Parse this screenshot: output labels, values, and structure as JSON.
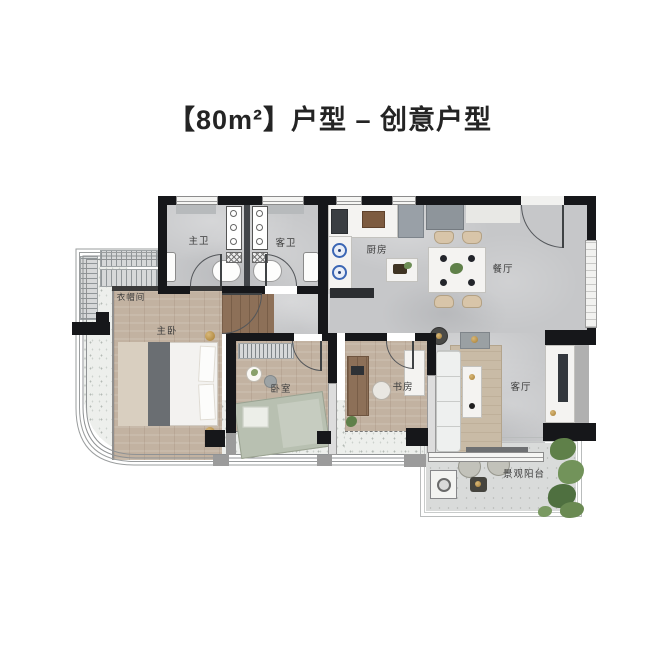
{
  "title": "【80m²】户型 – 创意户型",
  "rooms": {
    "master_bath": "主卫",
    "guest_bath": "客卫",
    "kitchen": "厨房",
    "dining": "餐厅",
    "cloakroom": "衣帽间",
    "master_bedroom": "主卧",
    "bedroom": "卧室",
    "study": "书房",
    "living": "客厅",
    "balcony": "景观阳台"
  },
  "colors": {
    "wall": "#16171a",
    "floor_marble": "#c6c7c9",
    "floor_wood": "#c2b2a1",
    "floor_walnut": "#8d7058",
    "floor_terrazzo": "#edefec",
    "bed_sage": "#b8c0b1",
    "plant_green": "#5f8049",
    "accent_gold": "#b9924f",
    "title_text": "#242424"
  }
}
